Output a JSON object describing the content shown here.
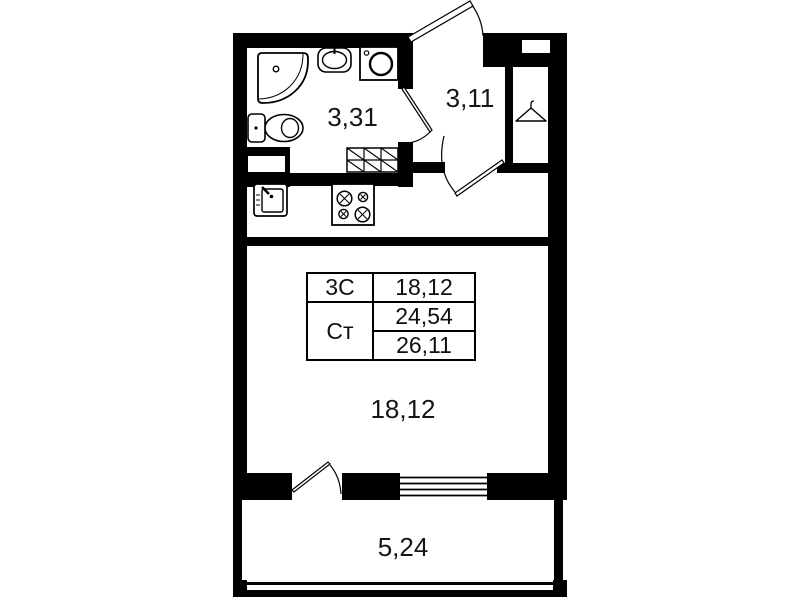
{
  "title": "Studio apartment floor plan",
  "floorplan": {
    "colors": {
      "walls": "#000000",
      "background": "#ffffff",
      "text": "#151515"
    },
    "rooms": [
      {
        "name": "bathroom",
        "area_label": "3,31"
      },
      {
        "name": "hallway",
        "area_label": "3,11"
      },
      {
        "name": "living-room",
        "area_label": "18,12"
      },
      {
        "name": "balcony",
        "area_label": "5,24"
      }
    ],
    "spec_table": {
      "rows": [
        {
          "label": "3С",
          "value": "18,12"
        },
        {
          "label": "Ст",
          "value": "24,54"
        },
        {
          "label": "",
          "value": "26,11"
        }
      ]
    },
    "icons": [
      "shower-icon",
      "washbasin-icon",
      "washing-machine-icon",
      "toilet-icon",
      "kitchen-sink-icon",
      "stove-icon",
      "hanger-icon",
      "vent-shaft-icon",
      "entrance-door-icon",
      "bathroom-door-icon",
      "room-door-icon",
      "balcony-door-icon",
      "window-icon",
      "balcony-railing"
    ]
  }
}
